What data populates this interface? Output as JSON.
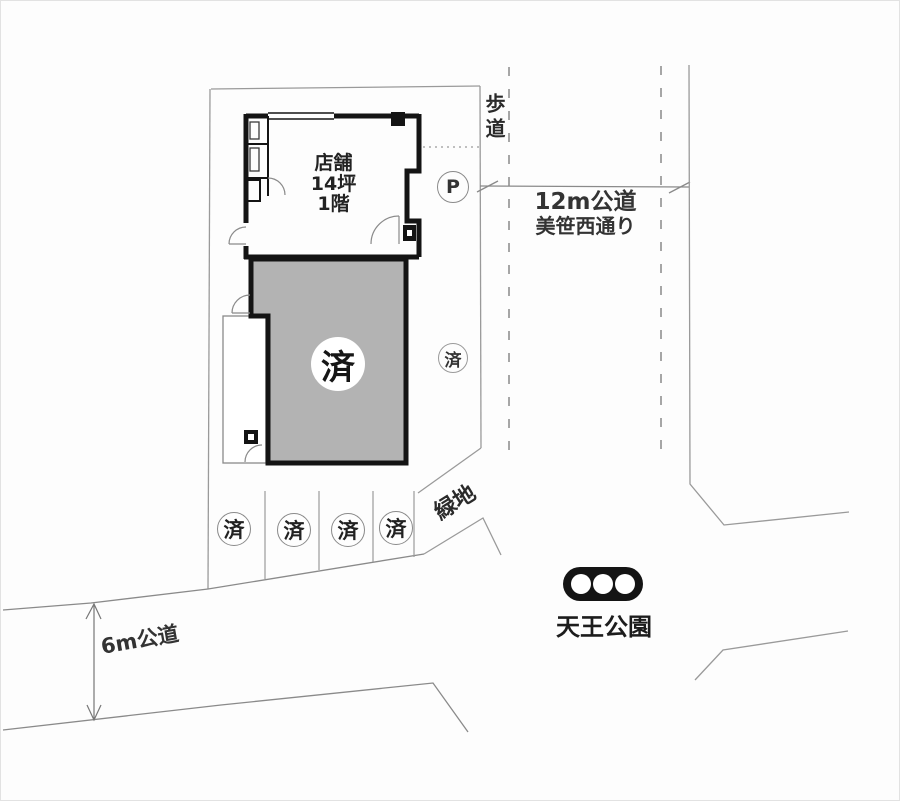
{
  "canvas": {
    "width": 900,
    "height": 801
  },
  "building": {
    "name_line1": "店舗",
    "name_line2": "14坪",
    "name_line3": "1階",
    "sold_mark": "済"
  },
  "side_lot": {
    "sold_mark": "済",
    "parking_symbol": "P"
  },
  "parking_spots": [
    {
      "status": "済"
    },
    {
      "status": "済"
    },
    {
      "status": "済"
    },
    {
      "status": "済"
    }
  ],
  "labels": {
    "sidewalk": "歩道",
    "road_12m_line1": "12m公道",
    "road_12m_line2": "美笹西通り",
    "green_area": "緑地",
    "road_6m": "6m公道",
    "park_name": "天王公園"
  },
  "colors": {
    "wall": "#141414",
    "sold_unit_fill": "#b3b3b3",
    "boundary_line": "#9a9a9a",
    "road_line": "#8a8a8a",
    "text": "#2a2a2a",
    "park_icon": "#141414"
  }
}
